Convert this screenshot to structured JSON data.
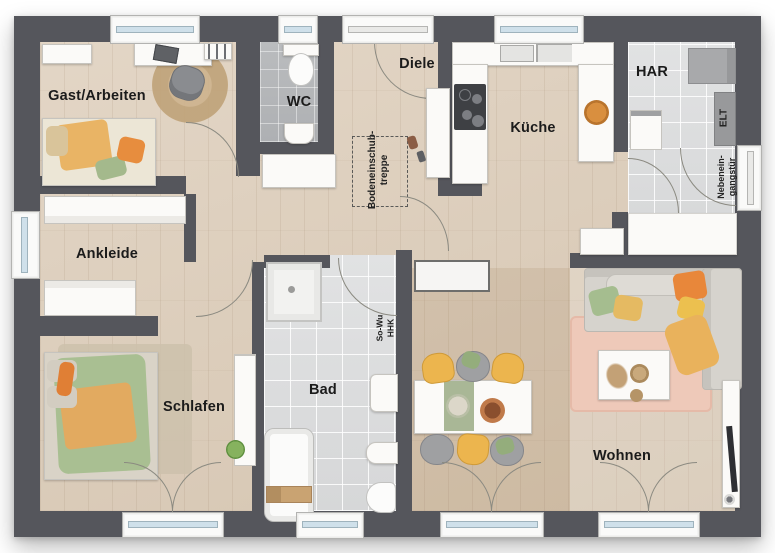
{
  "rooms": {
    "gast": "Gast/Arbeiten",
    "wc": "WC",
    "diele": "Diele",
    "kueche": "Küche",
    "har": "HAR",
    "ankleide": "Ankleide",
    "schlafen": "Schlafen",
    "bad": "Bad",
    "wohnen": "Wohnen"
  },
  "annotations": {
    "attic_stairs": {
      "line1": "Bodeneinschub-",
      "line2": "treppe"
    },
    "so_wu": {
      "line1": "So-Wu",
      "line2": "HHK"
    },
    "elt": "ELT",
    "side_entrance": {
      "line1": "Nebenein-",
      "line2": "gangstür"
    }
  },
  "colors": {
    "wall": "#55565c",
    "glass": "#cfe0ea",
    "accent_orange": "#e8873a",
    "accent_yellow": "#ecb54e",
    "accent_green": "#a9bf92",
    "rug_pink": "#eec9b9",
    "wood_light": "#e3d6c6",
    "tile_gray": "#b7b9bb"
  }
}
